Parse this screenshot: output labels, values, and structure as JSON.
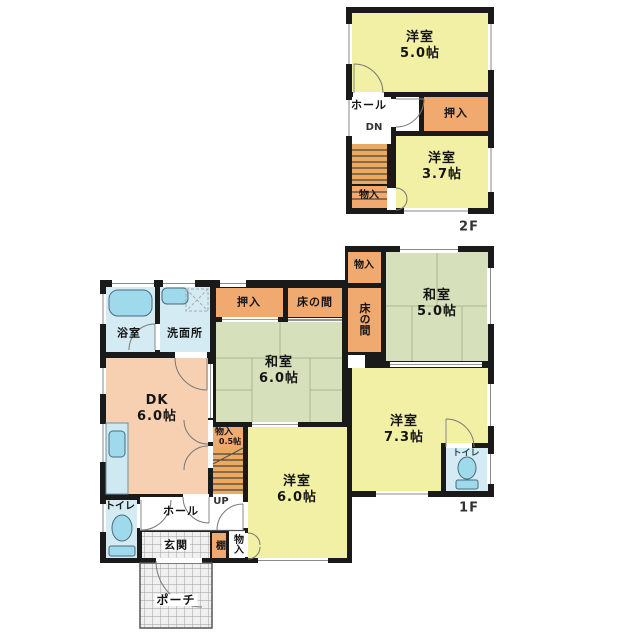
{
  "floor2": {
    "floor_label": "2F",
    "yoshitsu5": {
      "name": "洋室",
      "size": "5.0帖"
    },
    "hall": "ホール",
    "dn": "DN",
    "oshiire": "押入",
    "yoshitsu37": {
      "name": "洋室",
      "size": "3.7帖"
    },
    "monoire": "物入"
  },
  "floor1": {
    "floor_label": "1F",
    "monoire_top": "物入",
    "washitsu5": {
      "name": "和室",
      "size": "5.0帖"
    },
    "tokonoma_right": "床の間",
    "oshiire": "押入",
    "tokonoma": "床の間",
    "washitsu6": {
      "name": "和室",
      "size": "6.0帖"
    },
    "bathroom": "浴室",
    "washroom": "洗面所",
    "dk": {
      "name": "DK",
      "size": "6.0帖"
    },
    "monoire_stairs": {
      "name": "物入",
      "size": "0.5帖"
    },
    "up": "UP",
    "yoshitsu6": {
      "name": "洋室",
      "size": "6.0帖"
    },
    "yoshitsu73": {
      "name": "洋室",
      "size": "7.3帖"
    },
    "toilet_right": "トイレ",
    "toilet_left": "トイレ",
    "hall": "ホール",
    "genkan": "玄関",
    "tana": "棚",
    "monoire_bottom": "物入",
    "porch": "ポーチ"
  },
  "colors": {
    "wall": "#1a1a1a",
    "western_room": "#f2f0a4",
    "japanese_room": "#d6e0ba",
    "closet": "#f0a96e",
    "dk": "#f6d0b0",
    "wet_area": "#d4ebf4",
    "fixture": "#9fd9ec",
    "stairs": "#eaaa62",
    "tile": "#f0f0f0"
  }
}
